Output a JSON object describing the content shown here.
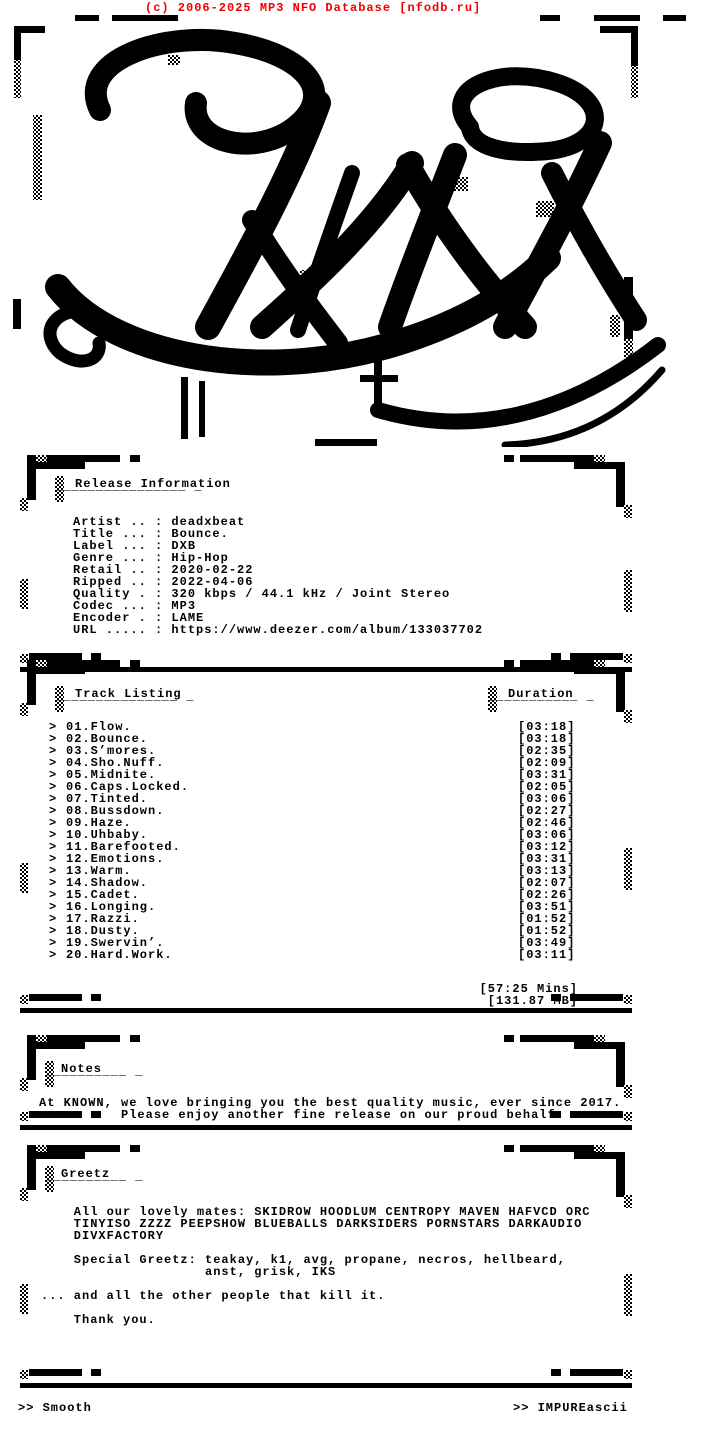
{
  "banner": {
    "text": "(c) 2006-2025 MP3 NFO Database [nfodb.ru]",
    "color": "#f00000"
  },
  "logo": {
    "sm": "sM"
  },
  "release_info": {
    "title": "Release Information",
    "underline": "¯¯¯¯¯¯¯¯¯¯¯¯¯¯¯¯ ¯",
    "lines": [
      "Artist .. : deadxbeat",
      "Title ... : Bounce.",
      "Label ... : DXB",
      "Genre ... : Hip-Hop",
      "Retail .. : 2020-02-22",
      "Ripped .. : 2022-04-06",
      "Quality . : 320 kbps / 44.1 kHz / Joint Stereo",
      "Codec ... : MP3",
      "Encoder . : LAME",
      "URL ..... : https://www.deezer.com/album/133037702"
    ]
  },
  "track_listing": {
    "title": "Track Listing",
    "underline": "¯¯¯¯¯¯¯¯¯¯¯¯¯¯¯ ¯",
    "duration_title": "Duration",
    "duration_underline": "¯¯¯¯¯¯¯¯¯¯¯ ¯",
    "prefix": ">",
    "tracks": [
      {
        "name": "01.Flow.",
        "duration": "[03:18]"
      },
      {
        "name": "02.Bounce.",
        "duration": "[03:18]"
      },
      {
        "name": "03.S’mores.",
        "duration": "[02:35]"
      },
      {
        "name": "04.Sho.Nuff.",
        "duration": "[02:09]"
      },
      {
        "name": "05.Midnite.",
        "duration": "[03:31]"
      },
      {
        "name": "06.Caps.Locked.",
        "duration": "[02:05]"
      },
      {
        "name": "07.Tinted.",
        "duration": "[03:06]"
      },
      {
        "name": "08.Bussdown.",
        "duration": "[02:27]"
      },
      {
        "name": "09.Haze.",
        "duration": "[02:46]"
      },
      {
        "name": "10.Uhbaby.",
        "duration": "[03:06]"
      },
      {
        "name": "11.Barefooted.",
        "duration": "[03:12]"
      },
      {
        "name": "12.Emotions.",
        "duration": "[03:31]"
      },
      {
        "name": "13.Warm.",
        "duration": "[03:13]"
      },
      {
        "name": "14.Shadow.",
        "duration": "[02:07]"
      },
      {
        "name": "15.Cadet.",
        "duration": "[02:26]"
      },
      {
        "name": "16.Longing.",
        "duration": "[03:51]"
      },
      {
        "name": "17.Razzi.",
        "duration": "[01:52]"
      },
      {
        "name": "18.Dusty.",
        "duration": "[01:52]"
      },
      {
        "name": "19.Swervin’.",
        "duration": "[03:49]"
      },
      {
        "name": "20.Hard.Work.",
        "duration": "[03:11]"
      }
    ],
    "total_time": "[57:25 Mins]",
    "total_size": "[131.87 MB]"
  },
  "notes": {
    "title": "Notes",
    "underline": "¯¯¯¯¯¯¯¯¯¯ ¯",
    "lines": [
      "At KNOWN, we love bringing you the best quality music, ever since 2017.",
      "          Please enjoy another fine release on our proud behalf."
    ]
  },
  "greetz": {
    "title": "Greetz",
    "underline": "¯¯¯¯¯¯¯¯¯¯ ¯",
    "lines": [
      "    All our lovely mates: SKIDROW HOODLUM CENTROPY MAVEN HAFVCD ORC",
      "    TINYISO ZZZZ PEEPSHOW BLUEBALLS DARKSIDERS PORNSTARS DARKAUDIO",
      "    DIVXFACTORY",
      "",
      "    Special Greetz: teakay, k1, avg, propane, necros, hellbeard,",
      "                    anst, grisk, IKS",
      "",
      "... and all the other people that kill it.",
      "",
      "    Thank you."
    ]
  },
  "footer": {
    "left": ">> Smooth",
    "right": ">> IMPUREascii"
  }
}
